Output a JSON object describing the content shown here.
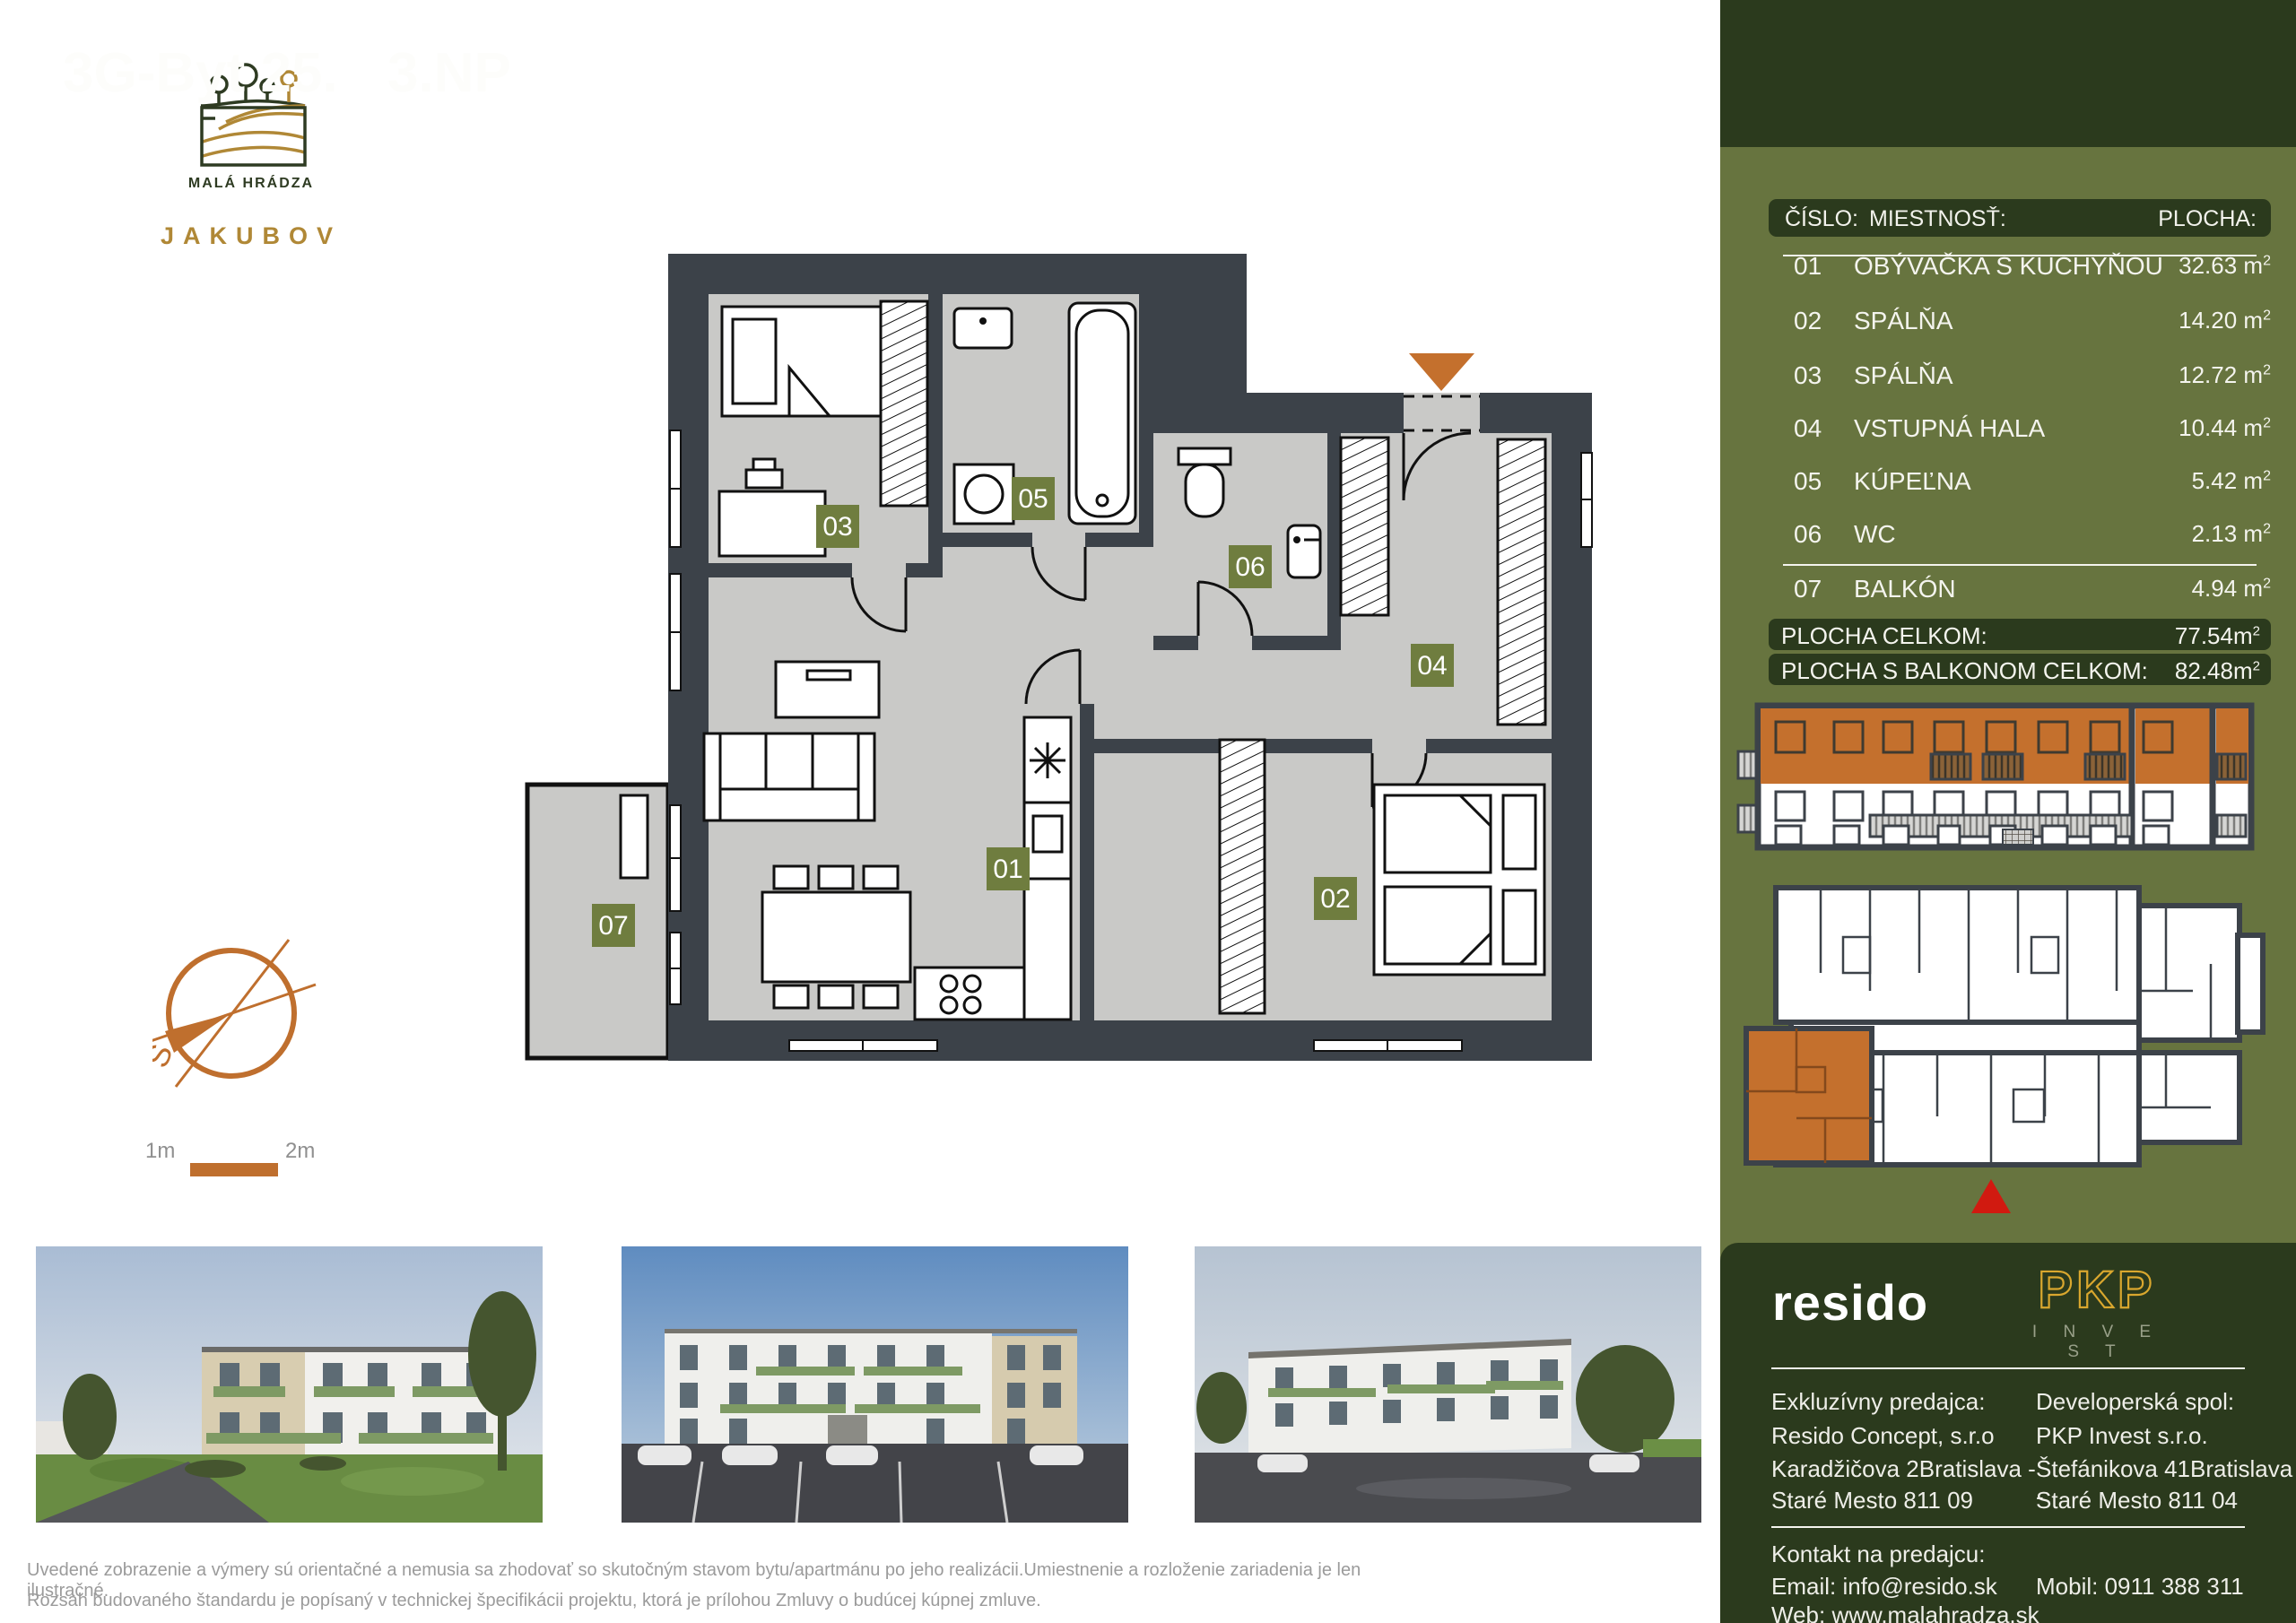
{
  "brand": {
    "name": "MALÁ HRÁDZA",
    "subname": "JAKUBOV"
  },
  "header": {
    "unit": "3G-Byt 25.",
    "floor": "3.NP"
  },
  "table": {
    "columns": {
      "num": "ČÍSLO:",
      "room": "MIESTNOSŤ:",
      "area": "PLOCHA:"
    },
    "unit": "m",
    "sup": "2",
    "rows": [
      {
        "num": "01",
        "room": "OBÝVAČKA S KUCHYŇOU",
        "area": "32.63"
      },
      {
        "num": "02",
        "room": "SPÁLŇA",
        "area": "14.20"
      },
      {
        "num": "03",
        "room": "SPÁLŇA",
        "area": "12.72"
      },
      {
        "num": "04",
        "room": "VSTUPNÁ HALA",
        "area": "10.44"
      },
      {
        "num": "05",
        "room": "KÚPEĽNA",
        "area": "5.42"
      },
      {
        "num": "06",
        "room": "WC",
        "area": "2.13"
      },
      {
        "num": "07",
        "room": "BALKÓN",
        "area": "4.94"
      }
    ],
    "totals": [
      {
        "label": "PLOCHA CELKOM:",
        "value": "77.54"
      },
      {
        "label": "PLOCHA S BALKONOM CELKOM:",
        "value": "82.48"
      }
    ]
  },
  "plan": {
    "labels": [
      "01",
      "02",
      "03",
      "04",
      "05",
      "06",
      "07"
    ],
    "scale": {
      "left": "1m",
      "right": "2m"
    },
    "compass": {
      "letter": "S"
    }
  },
  "footer": {
    "resido_logo": "resido",
    "pkp_logo": {
      "text": "PKP",
      "sub": "I N V E S T"
    },
    "left": {
      "role": "Exkluzívny predajca:",
      "company": "Resido Concept, s.r.o",
      "address1": "Karadžičova 2Bratislava -",
      "address2": "Staré Mesto 811 09"
    },
    "right": {
      "role": "Developerská spol:",
      "company": "PKP Invest s.r.o.",
      "address1": "Štefánikova 41Bratislava -",
      "address2": "Staré Mesto 811 04"
    },
    "contact": {
      "heading": "Kontakt na predajcu:",
      "email": "Email: info@resido.sk",
      "mobile": "Mobil: 0911 388 311",
      "web": "Web: www.malahradza.sk"
    }
  },
  "disclaimer": {
    "line1": "Uvedené zobrazenie a výmery sú orientačné a nemusia sa zhodovať so skutočným stavom bytu/apartmánu po jeho realizácii.Umiestnenie a rozloženie zariadenia je len ilustračné.",
    "line2": "Rozsah budovaného štandardu je popísaný v technickej špecifikácii projektu, ktorá je prílohou Zmluvy o budúcej kúpnej zmluve."
  },
  "colors": {
    "sidebar_olive": "#67743f",
    "dark_green": "#2b3a1d",
    "accent_orange": "#c4702d",
    "logo_gold": "#b08836",
    "pkp_gold": "#d9a72e",
    "wall": "#3c4249",
    "floor": "#c9c9c7",
    "highlight_red": "#d11a10"
  }
}
